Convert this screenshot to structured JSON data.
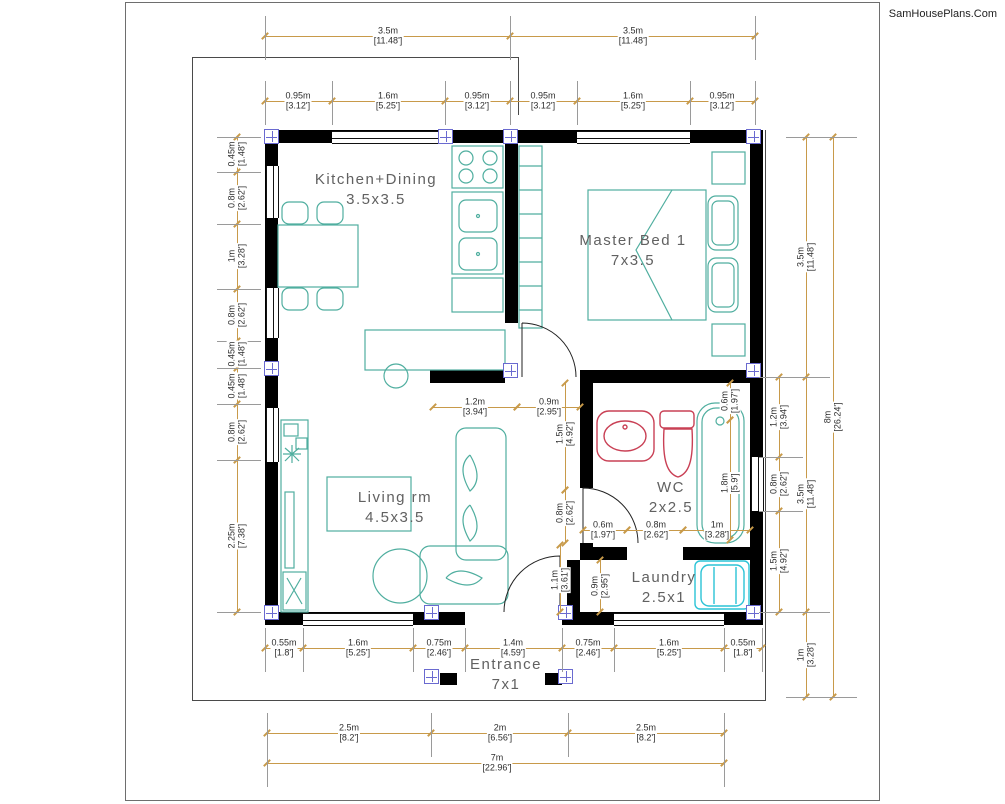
{
  "watermark": "SamHousePlans.Com",
  "rooms": [
    {
      "name": "Kitchen+Dining",
      "size": "3.5x3.5"
    },
    {
      "name": "Master Bed 1",
      "size": "7x3.5"
    },
    {
      "name": "Living rm",
      "size": "4.5x3.5"
    },
    {
      "name": "WC",
      "size": "2x2.5"
    },
    {
      "name": "Laundry",
      "size": "2.5x1"
    },
    {
      "name": "Entrance",
      "size": "7x1"
    }
  ],
  "plan_totals": {
    "width_m": "7m",
    "width_ft": "[22.96']",
    "height_m": "8m",
    "height_ft": "[26.24']"
  },
  "colors": {
    "wall": "#000000",
    "dim_line": "#c89a4a",
    "ext_line": "#9a9a9a",
    "dim_text": "#2e2e2e",
    "room_text": "#616161",
    "furniture": "#4fae9f",
    "fixture_red": "#c94055",
    "appliance_cyan": "#2bc3d6",
    "column": "#6a6ad0"
  },
  "dim_tiers": [
    {
      "name": "top-overall",
      "o": "h",
      "pos": 36,
      "from": 265,
      "to": 755,
      "ticks": [
        265,
        510,
        755
      ],
      "labels": [
        {
          "m": "3.5m",
          "ft": "[11.48']",
          "c": 388
        },
        {
          "m": "3.5m",
          "ft": "[11.48']",
          "c": 633
        }
      ]
    },
    {
      "name": "top-segments",
      "o": "h",
      "pos": 101,
      "from": 265,
      "to": 755,
      "ticks": [
        265,
        332,
        445,
        510,
        577,
        690,
        755
      ],
      "labels": [
        {
          "m": "0.95m",
          "ft": "[3.12']",
          "c": 298
        },
        {
          "m": "1.6m",
          "ft": "[5.25']",
          "c": 388
        },
        {
          "m": "0.95m",
          "ft": "[3.12']",
          "c": 477
        },
        {
          "m": "0.95m",
          "ft": "[3.12']",
          "c": 543
        },
        {
          "m": "1.6m",
          "ft": "[5.25']",
          "c": 633
        },
        {
          "m": "0.95m",
          "ft": "[3.12']",
          "c": 722
        }
      ]
    },
    {
      "name": "left-segments",
      "o": "v",
      "pos": 237,
      "from": 137,
      "to": 612,
      "ticks": [
        137,
        172,
        224,
        289,
        341,
        368,
        404,
        460,
        612
      ],
      "labels": [
        {
          "m": "0.45m",
          "ft": "[1.48']",
          "c": 154
        },
        {
          "m": "0.8m",
          "ft": "[2.62']",
          "c": 198
        },
        {
          "m": "1m",
          "ft": "[3.28']",
          "c": 256
        },
        {
          "m": "0.8m",
          "ft": "[2.62']",
          "c": 315
        },
        {
          "m": "0.45m",
          "ft": "[1.48']",
          "c": 354
        },
        {
          "m": "0.45m",
          "ft": "[1.48']",
          "c": 386
        },
        {
          "m": "0.8m",
          "ft": "[2.62']",
          "c": 432
        },
        {
          "m": "2.25m",
          "ft": "[7.38']",
          "c": 536
        }
      ]
    },
    {
      "name": "bottom-segments",
      "o": "h",
      "pos": 648,
      "from": 265,
      "to": 762,
      "ticks": [
        265,
        303,
        413,
        465,
        562,
        614,
        724,
        762
      ],
      "labels": [
        {
          "m": "0.55m",
          "ft": "[1.8']",
          "c": 284
        },
        {
          "m": "1.6m",
          "ft": "[5.25']",
          "c": 358
        },
        {
          "m": "0.75m",
          "ft": "[2.46']",
          "c": 439
        },
        {
          "m": "1.4m",
          "ft": "[4.59']",
          "c": 513
        },
        {
          "m": "0.75m",
          "ft": "[2.46']",
          "c": 588
        },
        {
          "m": "1.6m",
          "ft": "[5.25']",
          "c": 669
        },
        {
          "m": "0.55m",
          "ft": "[1.8']",
          "c": 743
        }
      ]
    },
    {
      "name": "bottom-spans",
      "o": "h",
      "pos": 733,
      "from": 267,
      "to": 724,
      "ticks": [
        267,
        431,
        568,
        724
      ],
      "labels": [
        {
          "m": "2.5m",
          "ft": "[8.2']",
          "c": 349
        },
        {
          "m": "2m",
          "ft": "[6.56']",
          "c": 500
        },
        {
          "m": "2.5m",
          "ft": "[8.2']",
          "c": 646
        }
      ]
    },
    {
      "name": "bottom-total",
      "o": "h",
      "pos": 763,
      "from": 267,
      "to": 724,
      "ticks": [
        267,
        724
      ],
      "labels": [
        {
          "m": "7m",
          "ft": "[22.96']",
          "c": 497
        }
      ]
    },
    {
      "name": "right-segments",
      "o": "v",
      "pos": 779,
      "from": 377,
      "to": 612,
      "ticks": [
        377,
        457,
        511,
        612
      ],
      "labels": [
        {
          "m": "1.2m",
          "ft": "[3.94']",
          "c": 417
        },
        {
          "m": "0.8m",
          "ft": "[2.62']",
          "c": 484
        },
        {
          "m": "1.5m",
          "ft": "[4.92']",
          "c": 561
        }
      ]
    },
    {
      "name": "right-spans",
      "o": "v",
      "pos": 806,
      "from": 137,
      "to": 697,
      "ticks": [
        137,
        377,
        612,
        697
      ],
      "labels": [
        {
          "m": "3.5m",
          "ft": "[11.48']",
          "c": 257
        },
        {
          "m": "3.5m",
          "ft": "[11.48']",
          "c": 494
        },
        {
          "m": "1m",
          "ft": "[3.28']",
          "c": 655
        }
      ]
    },
    {
      "name": "right-total",
      "o": "v",
      "pos": 833,
      "from": 137,
      "to": 697,
      "ticks": [
        137,
        697
      ],
      "labels": [
        {
          "m": "8m",
          "ft": "[26.24']",
          "c": 417
        }
      ]
    }
  ],
  "interior_dims": [
    {
      "o": "h",
      "pos": 407,
      "from": 433,
      "to": 517,
      "m": "1.2m",
      "ft": "[3.94']",
      "c": 475
    },
    {
      "o": "h",
      "pos": 407,
      "from": 517,
      "to": 580,
      "m": "0.9m",
      "ft": "[2.95']",
      "c": 549
    },
    {
      "o": "v",
      "pos": 565,
      "from": 383,
      "to": 490,
      "m": "1.5m",
      "ft": "[4.92']",
      "c": 434
    },
    {
      "o": "v",
      "pos": 565,
      "from": 490,
      "to": 543,
      "m": "0.8m",
      "ft": "[2.62']",
      "c": 513
    },
    {
      "o": "h",
      "pos": 530,
      "from": 583,
      "to": 627,
      "m": "0.6m",
      "ft": "[1.97']",
      "c": 603
    },
    {
      "o": "h",
      "pos": 530,
      "from": 627,
      "to": 683,
      "m": "0.8m",
      "ft": "[2.62']",
      "c": 656
    },
    {
      "o": "h",
      "pos": 530,
      "from": 683,
      "to": 750,
      "m": "1m",
      "ft": "[3.28']",
      "c": 717
    },
    {
      "o": "v",
      "pos": 730,
      "from": 383,
      "to": 420,
      "m": "0.6m",
      "ft": "[1.97']",
      "c": 401
    },
    {
      "o": "v",
      "pos": 730,
      "from": 420,
      "to": 540,
      "m": "1.8m",
      "ft": "[5.9']",
      "c": 483
    },
    {
      "o": "v",
      "pos": 560,
      "from": 545,
      "to": 612,
      "m": "1.1m",
      "ft": "[3.61']",
      "c": 580
    },
    {
      "o": "v",
      "pos": 600,
      "from": 560,
      "to": 612,
      "m": "0.9m",
      "ft": "[2.95']",
      "c": 586
    }
  ]
}
